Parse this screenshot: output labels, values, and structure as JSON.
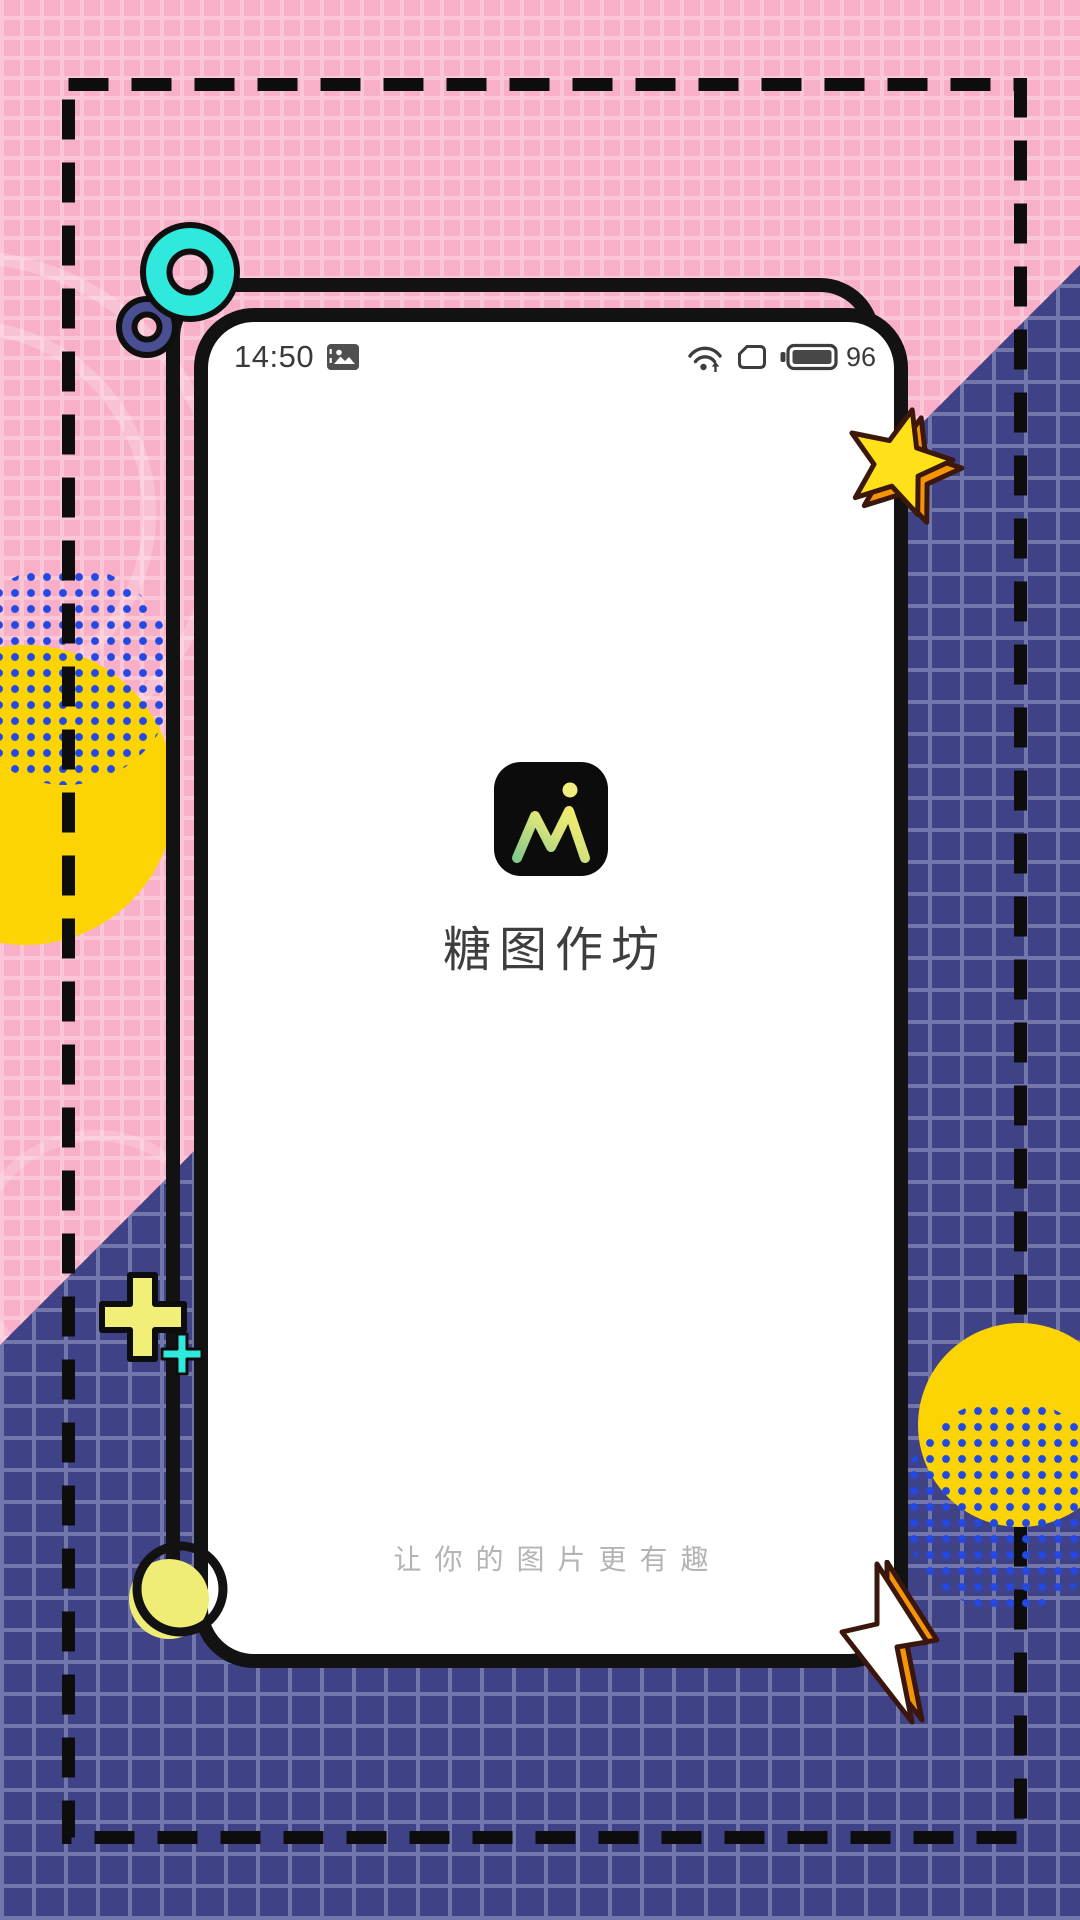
{
  "poster": {
    "style": "memphis-splash-poster",
    "colors": {
      "pink_bg": "#f8b0c8",
      "pink_grid": "#fbc7d7",
      "blue_bg": "#3f4286",
      "blue_grid": "#7276ab",
      "dashed_border": "#0d0d0d",
      "yellow_circle": "#fcd303",
      "pale_yellow": "#f0ed76",
      "dot_blue": "#2349e4",
      "cyan": "#2fe9dd",
      "purple_ring": "#4a4e92",
      "star_yellow": "#ffe11a",
      "extrude_orange": "#f59407",
      "phone_frame": "#121212"
    }
  },
  "phone": {
    "status_bar": {
      "time": "14:50",
      "battery_percent": "96",
      "icons": [
        "picture",
        "wifi-with-up-arrow",
        "sim-card",
        "battery"
      ]
    },
    "splash": {
      "app_name": "糖图作坊",
      "tagline": "让你的图片更有趣",
      "logo_glyph": "M",
      "logo_gradient": [
        "#86c98b",
        "#f5ec6a"
      ],
      "logo_dot_color": "#f2ee7e",
      "icon_bg": "#0c0c0c"
    }
  }
}
